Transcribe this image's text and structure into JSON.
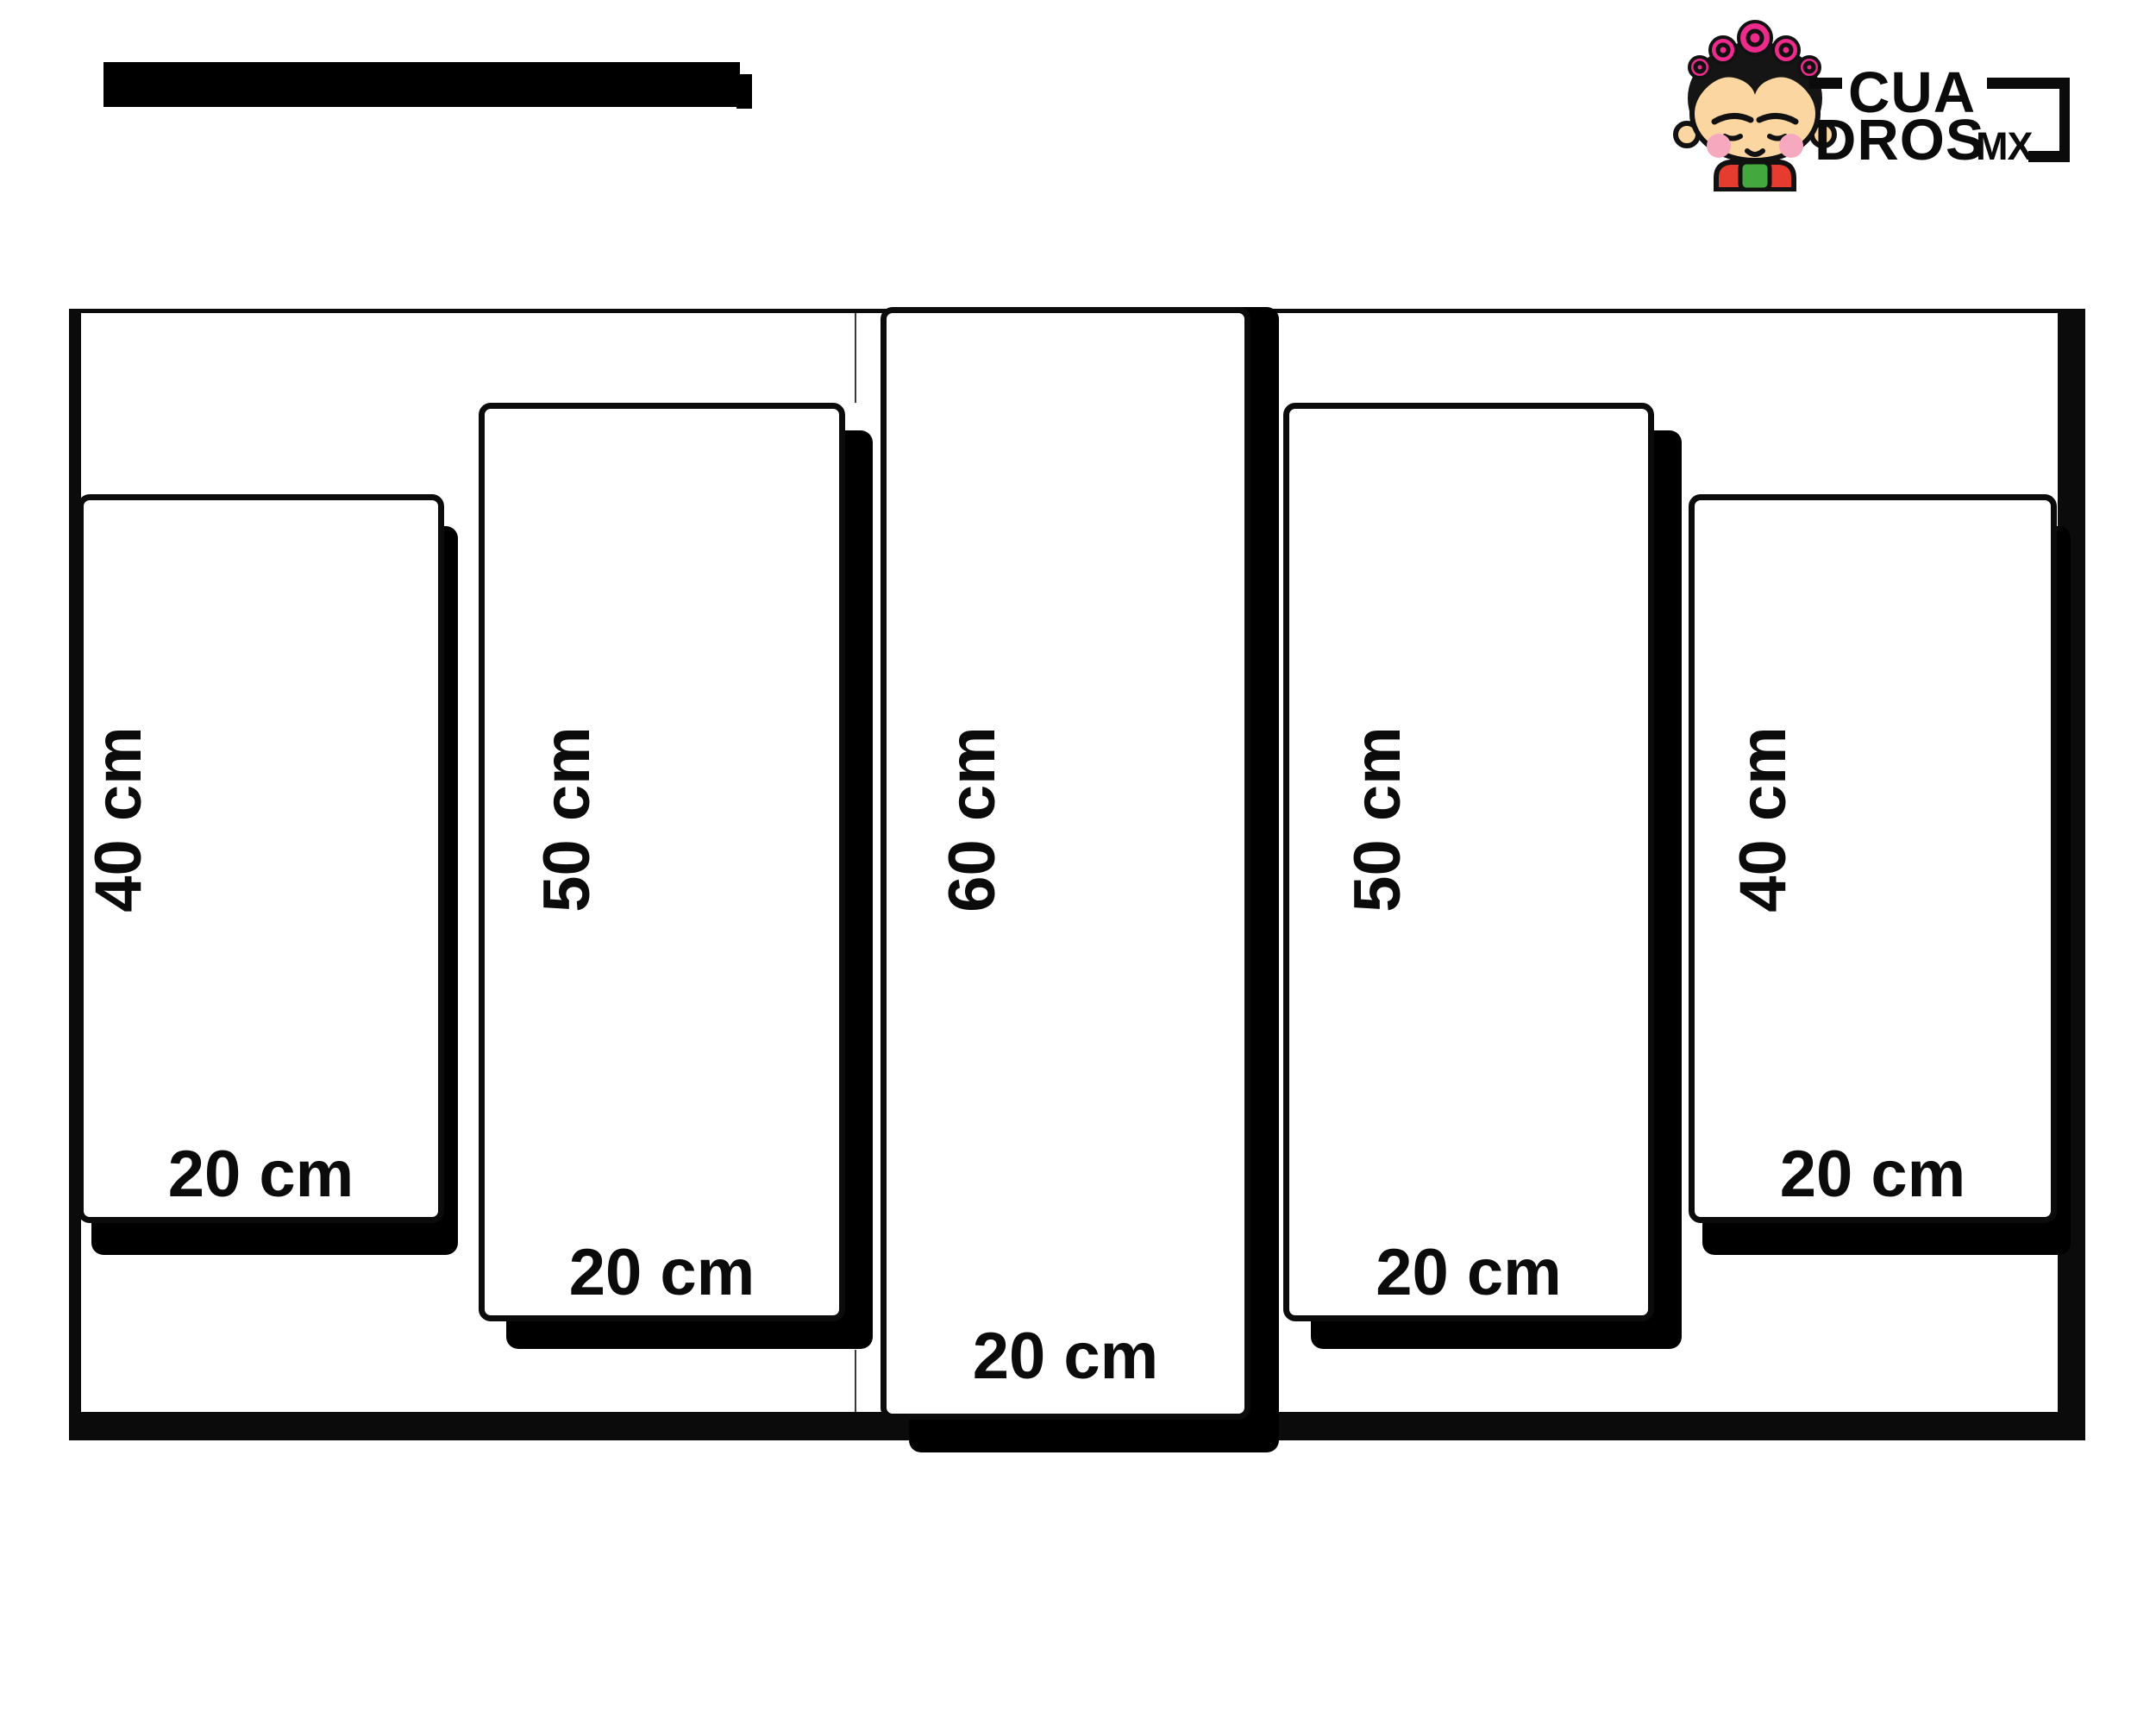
{
  "header": {
    "redacted_title_present": true
  },
  "logo": {
    "brand_icon": "frida-girl-icon",
    "word_top": "CUA",
    "word_bottom": "DROS",
    "suffix": "MX"
  },
  "diagram": {
    "type": "multi-panel-canvas-size-diagram",
    "panel_count": 5,
    "panels": [
      {
        "name": "panel-1",
        "height_label": "40 cm",
        "width_label": "20 cm"
      },
      {
        "name": "panel-2",
        "height_label": "50 cm",
        "width_label": "20 cm"
      },
      {
        "name": "panel-3",
        "height_label": "60 cm",
        "width_label": "20 cm"
      },
      {
        "name": "panel-4",
        "height_label": "50 cm",
        "width_label": "20 cm"
      },
      {
        "name": "panel-5",
        "height_label": "40 cm",
        "width_label": "20 cm"
      }
    ]
  },
  "colors": {
    "ink": "#0b0b0b",
    "background": "#ffffff",
    "logo_pink": "#EC2B8B",
    "logo_skin": "#FBD6A0",
    "logo_cheek": "#F5A8BE",
    "logo_red": "#E63B2F",
    "logo_green": "#43A83D",
    "logo_hair": "#151515"
  }
}
